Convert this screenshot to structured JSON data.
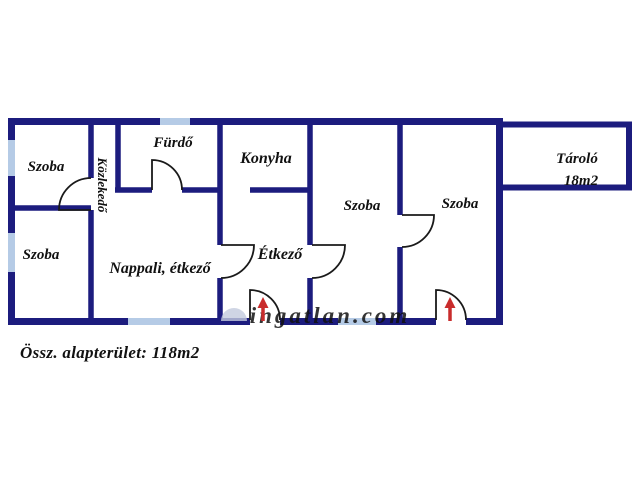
{
  "colors": {
    "wall": "#1c1c7e",
    "window": "#b5cbe6",
    "door": "#1a1a1a",
    "arrow": "#c92c2c",
    "label": "#111111",
    "watermark": "#c3cadd"
  },
  "summary": {
    "total_area_label": "Össz. alapterület: 118m2"
  },
  "watermark": {
    "text": "ingatlan.com",
    "x": 330,
    "y": 323,
    "size": 23
  },
  "floorplan": {
    "walls": [
      {
        "x1": 8,
        "y1": 121.5,
        "x2": 503,
        "y2": 121.5,
        "w": 7
      },
      {
        "x1": 11.5,
        "y1": 118,
        "x2": 11.5,
        "y2": 325,
        "w": 7
      },
      {
        "x1": 499.5,
        "y1": 118,
        "x2": 499.5,
        "y2": 325,
        "w": 7
      },
      {
        "x1": 8,
        "y1": 321.5,
        "x2": 250,
        "y2": 321.5,
        "w": 7
      },
      {
        "x1": 280,
        "y1": 321.5,
        "x2": 436,
        "y2": 321.5,
        "w": 7
      },
      {
        "x1": 466,
        "y1": 321.5,
        "x2": 503,
        "y2": 321.5,
        "w": 7
      },
      {
        "x1": 500,
        "y1": 124.5,
        "x2": 632,
        "y2": 124.5,
        "w": 6
      },
      {
        "x1": 629,
        "y1": 121.5,
        "x2": 629,
        "y2": 190,
        "w": 6
      },
      {
        "x1": 500,
        "y1": 187.5,
        "x2": 632,
        "y2": 187.5,
        "w": 6
      },
      {
        "x1": 91,
        "y1": 118,
        "x2": 91,
        "y2": 178,
        "w": 5.5
      },
      {
        "x1": 91,
        "y1": 210,
        "x2": 91,
        "y2": 325,
        "w": 5.5
      },
      {
        "x1": 8,
        "y1": 208,
        "x2": 91,
        "y2": 208,
        "w": 5.5
      },
      {
        "x1": 118,
        "y1": 118,
        "x2": 118,
        "y2": 190,
        "w": 5.5
      },
      {
        "x1": 115,
        "y1": 190,
        "x2": 152,
        "y2": 190,
        "w": 5.5
      },
      {
        "x1": 182,
        "y1": 190,
        "x2": 222,
        "y2": 190,
        "w": 5.5
      },
      {
        "x1": 220,
        "y1": 118,
        "x2": 220,
        "y2": 245,
        "w": 5.5
      },
      {
        "x1": 220,
        "y1": 278,
        "x2": 220,
        "y2": 325,
        "w": 5.5
      },
      {
        "x1": 250,
        "y1": 190,
        "x2": 312,
        "y2": 190,
        "w": 5.5
      },
      {
        "x1": 310,
        "y1": 118,
        "x2": 310,
        "y2": 245,
        "w": 5.5
      },
      {
        "x1": 310,
        "y1": 278,
        "x2": 310,
        "y2": 325,
        "w": 5.5
      },
      {
        "x1": 400,
        "y1": 118,
        "x2": 400,
        "y2": 215,
        "w": 5.5
      },
      {
        "x1": 400,
        "y1": 247,
        "x2": 400,
        "y2": 325,
        "w": 5.5
      }
    ],
    "windows": [
      {
        "x": 8,
        "y": 140,
        "w": 7,
        "h": 36
      },
      {
        "x": 8,
        "y": 233,
        "w": 7,
        "h": 39
      },
      {
        "x": 160,
        "y": 118,
        "w": 30,
        "h": 7
      },
      {
        "x": 128,
        "y": 318,
        "w": 42,
        "h": 7
      },
      {
        "x": 338,
        "y": 318,
        "w": 38,
        "h": 7
      }
    ],
    "doors": [
      {
        "hx": 91,
        "hy": 210,
        "lx": 59,
        "ly": 210,
        "jx": 91,
        "jy": 178
      },
      {
        "hx": 152,
        "hy": 190,
        "lx": 152,
        "ly": 160,
        "jx": 182,
        "jy": 190
      },
      {
        "hx": 221,
        "hy": 245,
        "lx": 254,
        "ly": 245,
        "jx": 221,
        "jy": 278
      },
      {
        "hx": 312,
        "hy": 245,
        "lx": 345,
        "ly": 245,
        "jx": 312,
        "jy": 278
      },
      {
        "hx": 402,
        "hy": 215,
        "lx": 434,
        "ly": 215,
        "jx": 402,
        "jy": 247
      },
      {
        "hx": 250,
        "hy": 320,
        "lx": 250,
        "ly": 290,
        "jx": 280,
        "jy": 320
      },
      {
        "hx": 436,
        "hy": 320,
        "lx": 436,
        "ly": 290,
        "jx": 466,
        "jy": 320
      }
    ],
    "entrance_arrows": [
      {
        "x": 263,
        "y1": 321,
        "y2": 303
      },
      {
        "x": 450,
        "y1": 321,
        "y2": 303
      }
    ],
    "room_labels": [
      {
        "text": "Szoba",
        "x": 46,
        "y": 171,
        "size": 15
      },
      {
        "text": "Közlekedő",
        "x": 98,
        "y": 185,
        "size": 13,
        "rotate": 90
      },
      {
        "text": "Fürdő",
        "x": 173,
        "y": 147,
        "size": 15
      },
      {
        "text": "Konyha",
        "x": 266,
        "y": 163,
        "size": 16
      },
      {
        "text": "Szoba",
        "x": 362,
        "y": 210,
        "size": 15
      },
      {
        "text": "Szoba",
        "x": 460,
        "y": 208,
        "size": 15
      },
      {
        "text": "Tároló",
        "x": 577,
        "y": 163,
        "size": 15
      },
      {
        "text": "18m2",
        "x": 581,
        "y": 185,
        "size": 15
      },
      {
        "text": "Szoba",
        "x": 41,
        "y": 259,
        "size": 15
      },
      {
        "text": "Nappali, étkező",
        "x": 160,
        "y": 273,
        "size": 16
      },
      {
        "text": "Étkező",
        "x": 280,
        "y": 259,
        "size": 16
      }
    ]
  }
}
